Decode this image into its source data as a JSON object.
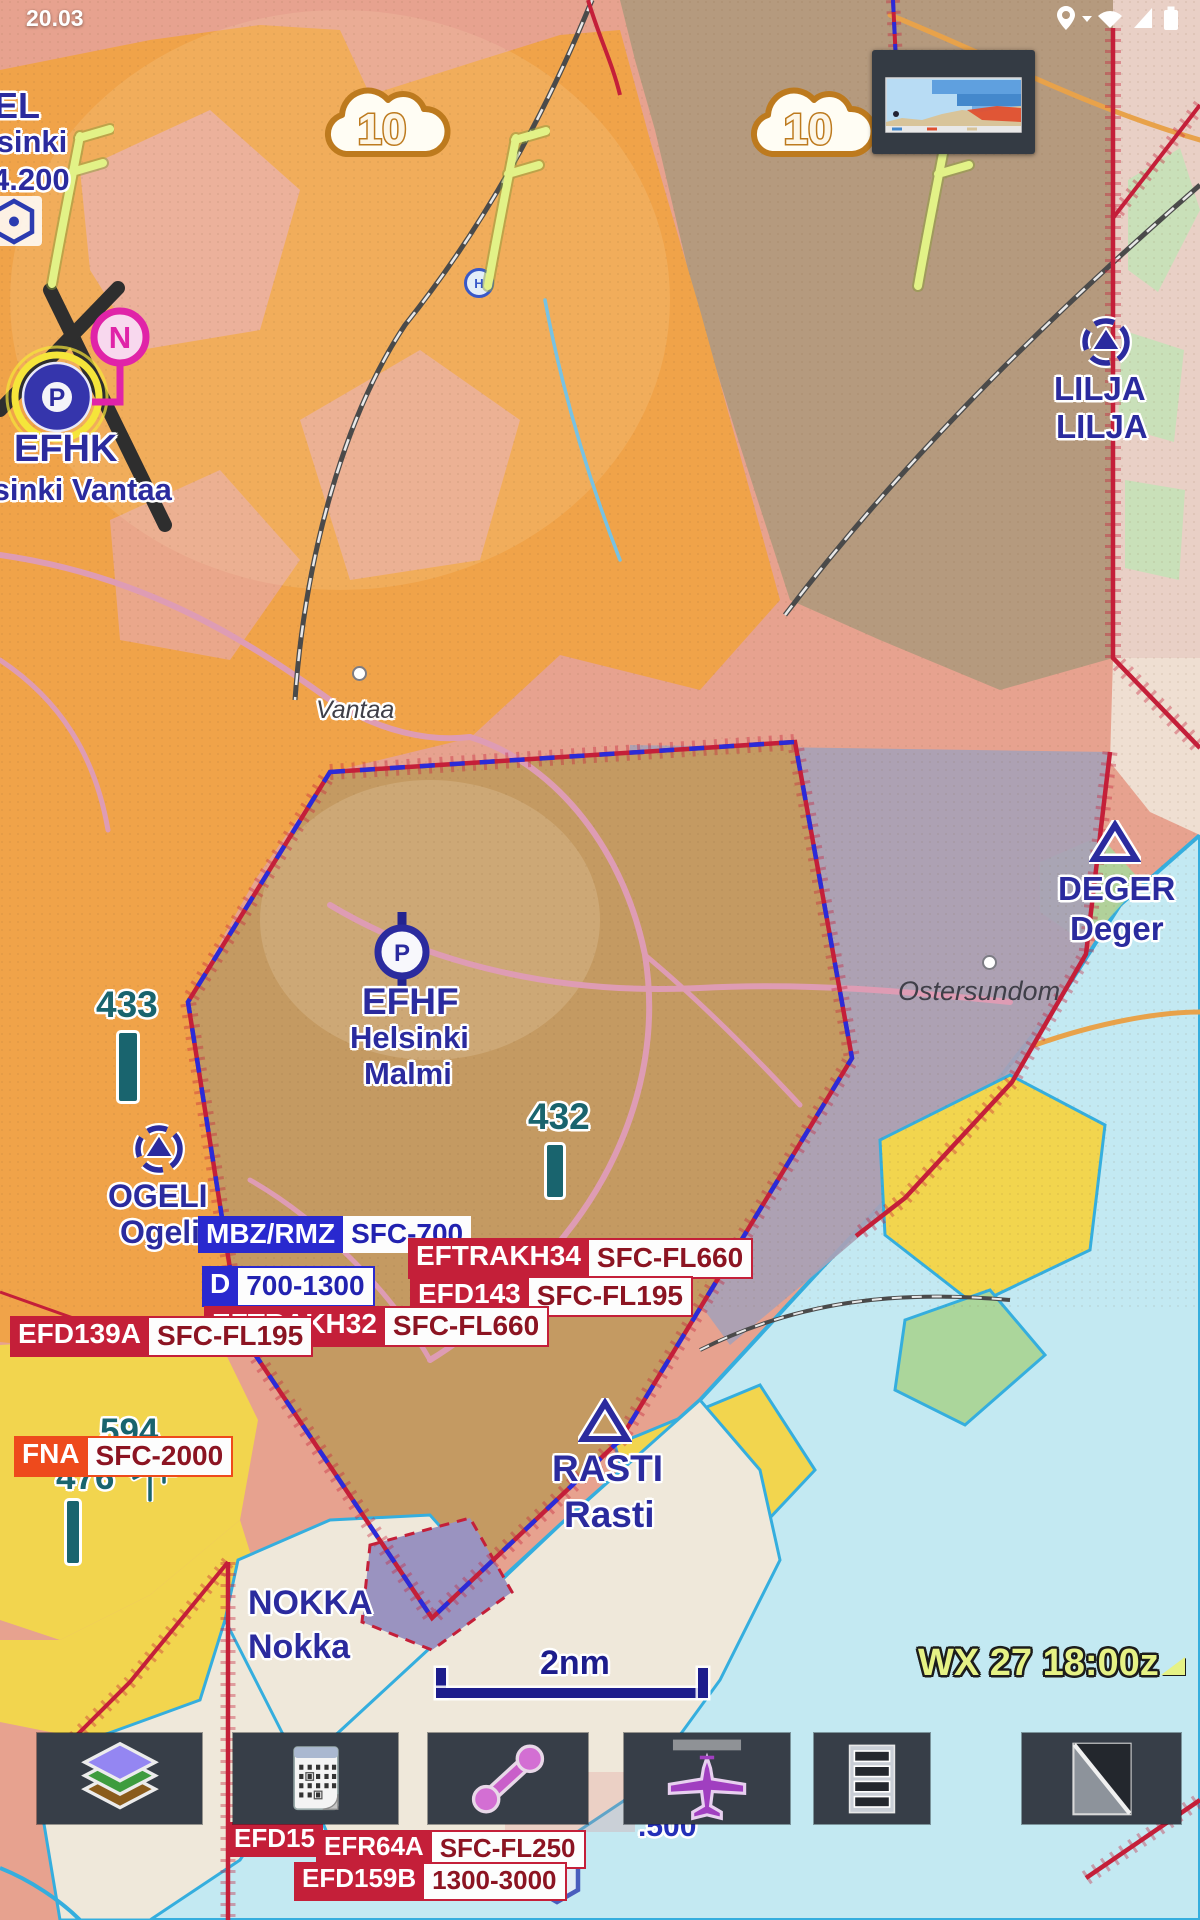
{
  "status_bar": {
    "time": "20.03",
    "icons": [
      "location-icon",
      "caret-down-icon",
      "wifi-icon",
      "signal-icon",
      "battery-icon"
    ]
  },
  "clouds": {
    "left": "10",
    "right": "10"
  },
  "top_left_partial": {
    "line1": "EL",
    "line2": "lsinki",
    "line3": "4.200"
  },
  "efhk": {
    "code": "EFHK",
    "name": "lsinki Vantaa",
    "beacon_letter": "N",
    "symbol_letter": "P"
  },
  "efhf": {
    "code": "EFHF",
    "name1": "Helsinki",
    "name2": "Malmi",
    "symbol_letter": "P"
  },
  "helipad": {
    "letter": "H"
  },
  "waypoints": {
    "lilja1": "LILJA",
    "lilja2": "LILJA",
    "ogeli1": "OGELI",
    "ogeli2": "Ogeli",
    "deger1": "DEGER",
    "deger2": "Deger",
    "rasti1": "RASTI",
    "rasti2": "Rasti",
    "nokka1": "NOKKA",
    "nokka2": "Nokka"
  },
  "towns": {
    "vantaa": "Vantaa",
    "ostersundom": "Ostersundom"
  },
  "obstacles": {
    "o433": "433",
    "o432": "432",
    "o594": "594",
    "o476": "476"
  },
  "airspace": {
    "mbz": {
      "name": "MBZ/RMZ",
      "value": "SFC-700"
    },
    "d": {
      "name": "D",
      "value": "700-1300"
    },
    "eftrakh34": {
      "name": "EFTRAKH34",
      "value": "SFC-FL660"
    },
    "efd143": {
      "name": "EFD143",
      "value": "SFC-FL195"
    },
    "eftrakh32": {
      "name": "EFTRAKH32",
      "value": "SFC-FL660"
    },
    "efd139a": {
      "name": "EFD139A",
      "value": "SFC-FL195"
    },
    "fna": {
      "name": "FNA",
      "value": "SFC-2000"
    },
    "efd15": {
      "name": "EFD15"
    },
    "efr64a": {
      "name": "EFR64A",
      "value": "SFC-FL250"
    },
    "efd159b": {
      "name": "EFD159B",
      "value": "1300-3000"
    },
    "partial_freq": ".500"
  },
  "scale": {
    "label": "2nm"
  },
  "wx": {
    "banner": "WX 27 18:00z"
  },
  "toolbar": {
    "buttons": [
      {
        "name": "layers"
      },
      {
        "name": "calendar"
      },
      {
        "name": "route"
      },
      {
        "name": "aircraft"
      },
      {
        "name": "list"
      },
      {
        "name": "terrain-corner"
      }
    ]
  },
  "colors": {
    "accent_blue": "#2b2b9e",
    "boundary_red": "#c41f39",
    "chip_blue": "#2929cf",
    "chip_orange": "#ee4a1c",
    "obstacle_teal": "#19646e",
    "wx_yellow": "#e6f285",
    "toolbar_bg": "#373e48",
    "water": "#c3e9f2",
    "urban_orange": "#f0a349"
  }
}
